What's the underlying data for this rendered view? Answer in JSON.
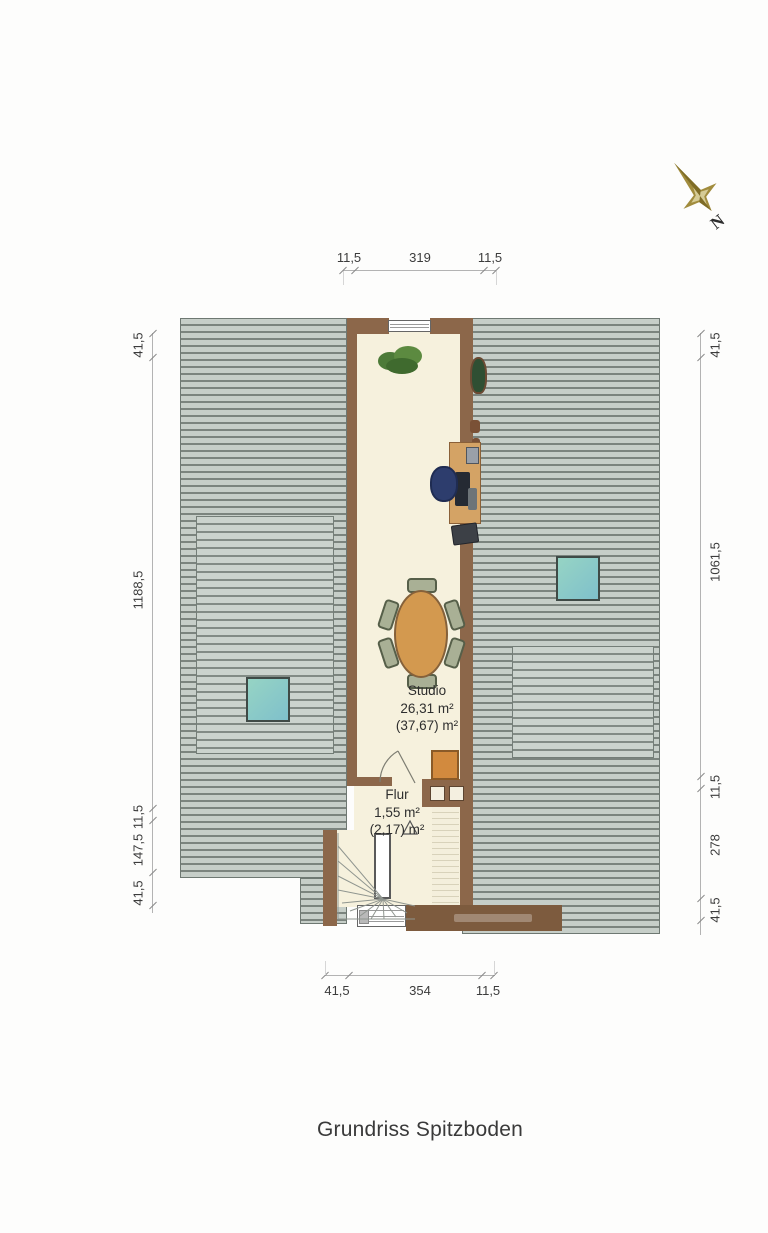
{
  "title": "Grundriss Spitzboden",
  "compass": {
    "label": "N"
  },
  "rooms": {
    "studio": {
      "name": "Studio",
      "area_net": "26,31 m²",
      "area_gross": "(37,67) m²"
    },
    "flur": {
      "name": "Flur",
      "area_net": "1,55 m²",
      "area_gross": "(2,17) m²"
    }
  },
  "dimensions": {
    "top": [
      "11,5",
      "319",
      "11,5"
    ],
    "bottom": [
      "41,5",
      "354",
      "11,5"
    ],
    "left": [
      "41,5",
      "1188,5",
      "11,5",
      "147,5",
      "41,5"
    ],
    "right": [
      "41,5",
      "1061,5",
      "11,5",
      "278",
      "41,5"
    ]
  },
  "colors": {
    "roof_stripe_light": "#c6cec8",
    "roof_stripe_dark": "#7b847e",
    "skylight": "#8fd0c8",
    "wall_brown": "#8c674a",
    "floor_cream": "#f6f1dd",
    "wood": "#d3994f",
    "cabinet_orange": "#d28a3e",
    "compass_gold": "#a18c3d"
  }
}
